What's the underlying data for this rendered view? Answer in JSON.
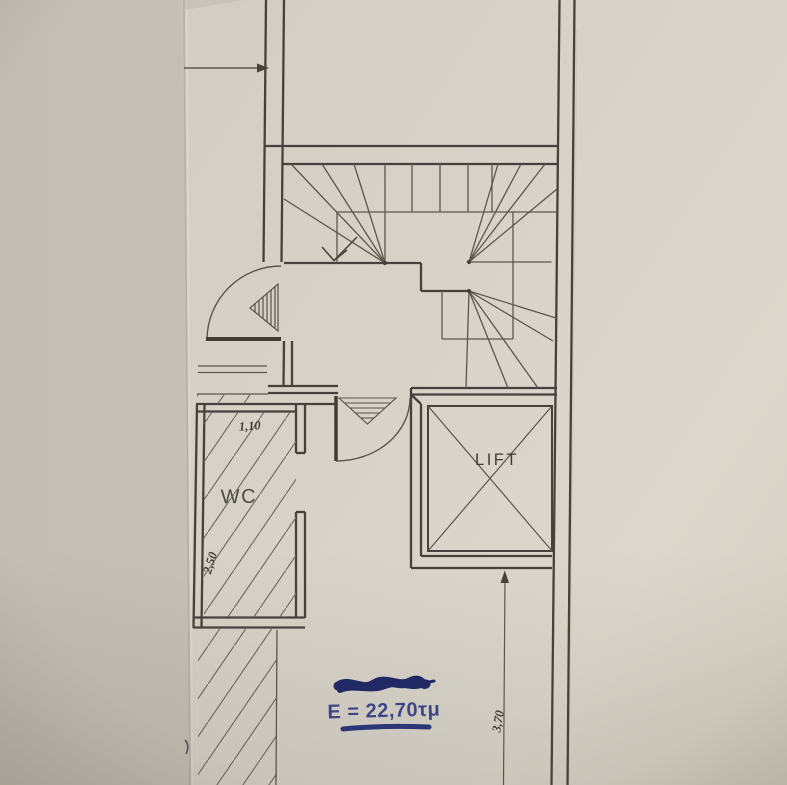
{
  "labels": {
    "wc": "WC",
    "lift": "LIFT",
    "area": "E = 22,70τμ"
  },
  "dims": {
    "wc_width": "1,10",
    "wc_depth": "2,50",
    "room_depth": "3,70"
  },
  "colors": {
    "paper": "#d8d4ca",
    "backdrop": "#c8c4ba",
    "line_dark": "#45423b",
    "line_thin": "#5b574d",
    "ink_blue": "#2c3988",
    "ink_scribble": "#1d2566"
  }
}
